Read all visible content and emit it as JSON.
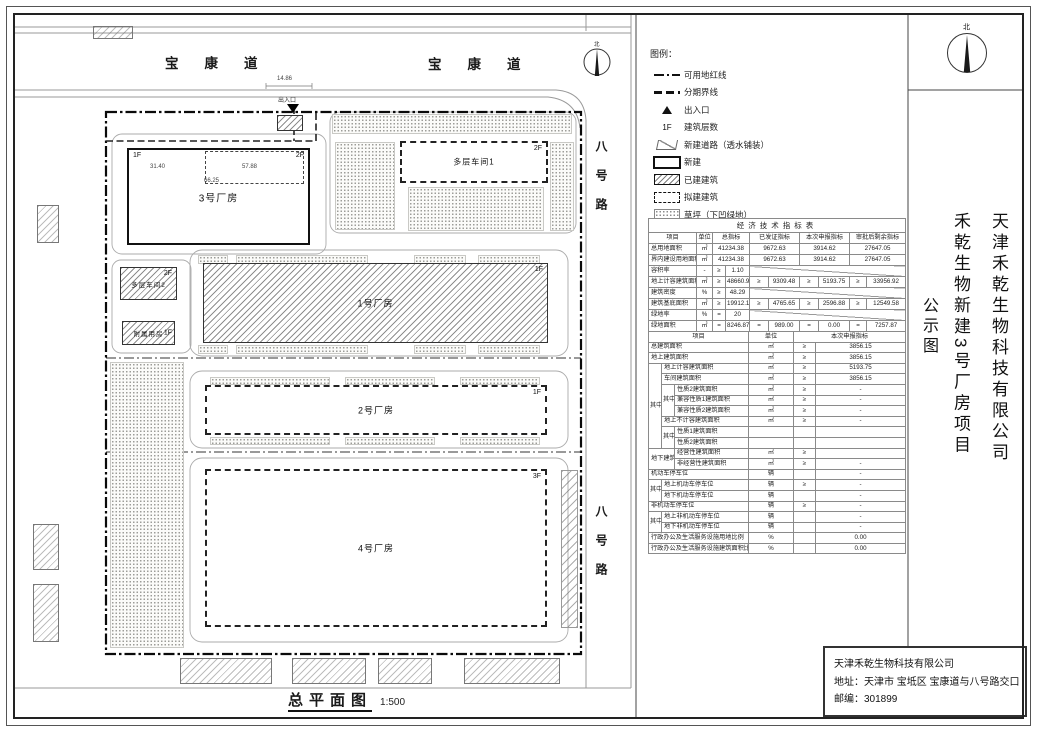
{
  "misc": {
    "north": "北"
  },
  "plan": {
    "title": "总平面图",
    "scale": "1:500",
    "roads": {
      "top1": "宝康道",
      "top2": "宝康道",
      "right1": "八号路",
      "right2": "八号路"
    },
    "entrance": {
      "label": "出入口",
      "dim": "14.86"
    },
    "dims": {
      "w1": "31.40",
      "w2": "57.88",
      "total": "66.25"
    },
    "buildings": [
      {
        "id": "plant3",
        "name": "3号厂房",
        "type": "new",
        "x": 127,
        "y": 148,
        "w": 183,
        "h": 97,
        "fs": 10,
        "fl": [
          [
            "1F",
            "tl"
          ],
          [
            "2F",
            "tr"
          ]
        ]
      },
      {
        "id": "plant3-2f-extent",
        "name": "",
        "type": "sub",
        "x": 205,
        "y": 151,
        "w": 99,
        "h": 33,
        "fl": []
      },
      {
        "id": "workshop1",
        "name": "多层车间1",
        "type": "proposed",
        "x": 400,
        "y": 141,
        "w": 148,
        "h": 42,
        "fs": 8,
        "fl": [
          [
            "2F",
            "tr"
          ]
        ]
      },
      {
        "id": "workshop2",
        "name": "多层车间2",
        "type": "existing",
        "x": 120,
        "y": 267,
        "w": 57,
        "h": 33,
        "fs": 6.5,
        "fl": [
          [
            "2F",
            "tr"
          ]
        ]
      },
      {
        "id": "annex",
        "name": "附属用房",
        "type": "existing",
        "x": 122,
        "y": 321,
        "w": 53,
        "h": 24,
        "fs": 6.5,
        "fl": [
          [
            "1F",
            "r"
          ]
        ]
      },
      {
        "id": "plant1",
        "name": "1号厂房",
        "type": "existing",
        "x": 203,
        "y": 263,
        "w": 345,
        "h": 80,
        "fs": 9,
        "fl": [
          [
            "1F",
            "tr"
          ]
        ]
      },
      {
        "id": "plant2",
        "name": "2号厂房",
        "type": "proposed",
        "x": 205,
        "y": 385,
        "w": 342,
        "h": 50,
        "fs": 9,
        "fl": [
          [
            "1F",
            "tr"
          ]
        ]
      },
      {
        "id": "plant4",
        "name": "4号厂房",
        "type": "proposed",
        "x": 205,
        "y": 469,
        "w": 342,
        "h": 158,
        "fs": 9,
        "fl": [
          [
            "3F",
            "tr"
          ]
        ]
      },
      {
        "id": "gatehouse",
        "name": "",
        "type": "existing",
        "x": 277,
        "y": 115,
        "w": 26,
        "h": 16,
        "fl": []
      }
    ],
    "lawns": [
      [
        332,
        114,
        240,
        20
      ],
      [
        335,
        142,
        60,
        88
      ],
      [
        408,
        187,
        136,
        44
      ],
      [
        550,
        142,
        24,
        89
      ],
      [
        198,
        255,
        30,
        9
      ],
      [
        236,
        255,
        132,
        9
      ],
      [
        414,
        255,
        52,
        9
      ],
      [
        478,
        255,
        62,
        9
      ],
      [
        198,
        345,
        30,
        9
      ],
      [
        236,
        345,
        132,
        9
      ],
      [
        414,
        345,
        52,
        9
      ],
      [
        478,
        345,
        62,
        9
      ],
      [
        210,
        377,
        120,
        8
      ],
      [
        345,
        377,
        90,
        8
      ],
      [
        460,
        377,
        80,
        8
      ],
      [
        210,
        437,
        120,
        8
      ],
      [
        345,
        437,
        90,
        8
      ],
      [
        460,
        437,
        80,
        8
      ],
      [
        110,
        362,
        74,
        286
      ]
    ],
    "parking": [
      [
        561,
        470,
        17,
        158
      ]
    ],
    "outside": [
      [
        180,
        658,
        92,
        26
      ],
      [
        292,
        658,
        74,
        26
      ],
      [
        378,
        658,
        54,
        26
      ],
      [
        464,
        658,
        96,
        26
      ],
      [
        37,
        205,
        22,
        38
      ],
      [
        33,
        524,
        26,
        46
      ],
      [
        33,
        584,
        26,
        58
      ],
      [
        93,
        26,
        40,
        13
      ]
    ]
  },
  "legend": {
    "title": "图例：",
    "items": [
      {
        "sym": "redline",
        "label": "可用地红线"
      },
      {
        "sym": "phaseline",
        "label": "分期界线"
      },
      {
        "sym": "entry",
        "label": "出入口"
      },
      {
        "sym": "floors",
        "symText": "1F",
        "label": "建筑层数"
      },
      {
        "sym": "newroad",
        "label": "新建道路（透水铺装）"
      },
      {
        "sym": "newbuild",
        "label": "新建"
      },
      {
        "sym": "built",
        "label": "已建建筑"
      },
      {
        "sym": "proposed",
        "label": "拟建建筑"
      },
      {
        "sym": "lawn",
        "label": "草坪（下凹绿地）"
      },
      {
        "sym": "parking",
        "label": "机动车停车位"
      }
    ]
  },
  "table": {
    "title": "经济技术指标表",
    "sec1": {
      "header": [
        {
          "t": "项目"
        },
        {
          "t": "单位"
        },
        {
          "t": "总指标",
          "cs": 2
        },
        {
          "t": "已发证指标",
          "cs": 2
        },
        {
          "t": "本次申报指标",
          "cs": 2
        },
        {
          "t": "审批后剩余指标",
          "cs": 2
        }
      ],
      "rows": [
        {
          "label": "总用地面积",
          "unit": "㎡",
          "g": [
            {
              "v": "41234.38"
            },
            {
              "v": "9672.63"
            },
            {
              "v": "3914.62"
            },
            {
              "v": "27647.05"
            }
          ]
        },
        {
          "label": "界内建设用地面积",
          "unit": "㎡",
          "g": [
            {
              "v": "41234.38"
            },
            {
              "v": "9672.63"
            },
            {
              "v": "3914.62"
            },
            {
              "v": "27647.05"
            }
          ]
        },
        {
          "label": "容积率",
          "unit": "-",
          "g": [
            {
              "s": "≥",
              "v": "1.10"
            },
            {
              "diag": 6
            }
          ]
        },
        {
          "label": "地上计容建筑面积",
          "unit": "㎡",
          "g": [
            {
              "s": "≥",
              "v": "48660.97"
            },
            {
              "s": "≥",
              "v": "9309.48"
            },
            {
              "s": "≥",
              "v": "5193.75"
            },
            {
              "s": "≥",
              "v": "33956.92"
            }
          ]
        },
        {
          "label": "建筑密度",
          "unit": "%",
          "g": [
            {
              "s": "≥",
              "v": "48.29"
            },
            {
              "diag": 6
            }
          ]
        },
        {
          "label": "建筑基底面积",
          "unit": "㎡",
          "g": [
            {
              "s": "≥",
              "v": "19912.11"
            },
            {
              "s": "≥",
              "v": "4765.65"
            },
            {
              "s": "≥",
              "v": "2596.88"
            },
            {
              "s": "≥",
              "v": "12549.58"
            }
          ]
        },
        {
          "label": "绿地率",
          "unit": "%",
          "g": [
            {
              "s": "=",
              "v": "20"
            },
            {
              "diag": 6
            }
          ]
        },
        {
          "label": "绿地面积",
          "unit": "㎡",
          "g": [
            {
              "s": "=",
              "v": "8246.87"
            },
            {
              "s": "=",
              "v": "989.00"
            },
            {
              "s": "=",
              "v": "0.00"
            },
            {
              "s": "=",
              "v": "7257.87"
            }
          ]
        }
      ]
    },
    "sec2": {
      "rows": [
        [
          {
            "t": "项目",
            "cs": 3
          },
          {
            "t": "单位"
          },
          {
            "t": "本次申报指标",
            "cs": 2
          }
        ],
        [
          {
            "t": "总建筑面积",
            "cs": 3,
            "cls": "lft"
          },
          {
            "t": "㎡"
          },
          {
            "t": "≥"
          },
          {
            "t": "3856.15"
          }
        ],
        [
          {
            "t": "地上建筑面积",
            "cs": 3,
            "cls": "lft"
          },
          {
            "t": "㎡"
          },
          {
            "t": "≥"
          },
          {
            "t": "3856.15"
          }
        ],
        [
          {
            "t": "其中",
            "rs": 8
          },
          {
            "t": "地上计容建筑面积",
            "cs": 2,
            "cls": "lft"
          },
          {
            "t": "㎡"
          },
          {
            "t": "≥"
          },
          {
            "t": "5193.75"
          }
        ],
        [
          {
            "t": "车间建筑面积",
            "cs": 2,
            "cls": "lft"
          },
          {
            "t": "㎡"
          },
          {
            "t": "≥"
          },
          {
            "t": "3856.15"
          }
        ],
        [
          {
            "t": "其中",
            "rs": 3
          },
          {
            "t": "性质2建筑面积",
            "cls": "lft"
          },
          {
            "t": "㎡"
          },
          {
            "t": "≥"
          },
          {
            "t": "-"
          }
        ],
        [
          {
            "t": "兼容性质1建筑面积",
            "cls": "lft"
          },
          {
            "t": "㎡"
          },
          {
            "t": "≥"
          },
          {
            "t": "-"
          }
        ],
        [
          {
            "t": "兼容性质2建筑面积",
            "cls": "lft"
          },
          {
            "t": "㎡"
          },
          {
            "t": "≥"
          },
          {
            "t": "-"
          }
        ],
        [
          {
            "t": "地上不计容建筑面积",
            "cs": 2,
            "cls": "lft"
          },
          {
            "t": "㎡"
          },
          {
            "t": "≥"
          },
          {
            "t": "-"
          }
        ],
        [
          {
            "t": "其中",
            "rs": 2
          },
          {
            "t": "性质1建筑面积",
            "cls": "lft"
          },
          {
            "t": ""
          },
          {
            "t": ""
          },
          {
            "t": ""
          }
        ],
        [
          {
            "t": "性质2建筑面积",
            "cls": "lft"
          },
          {
            "t": ""
          },
          {
            "t": ""
          },
          {
            "t": ""
          }
        ],
        [
          {
            "t": "地下建筑面积",
            "cs": 2,
            "rs": 2,
            "cls": "lft"
          },
          {
            "t": "经营性建筑面积",
            "cls": "lft"
          },
          {
            "t": "㎡"
          },
          {
            "t": "≥"
          },
          {
            "t": ""
          }
        ],
        [
          {
            "t": "非经营性建筑面积",
            "cls": "lft"
          },
          {
            "t": "㎡"
          },
          {
            "t": "≥"
          },
          {
            "t": "-"
          }
        ],
        [
          {
            "t": "机动车停车位",
            "cs": 3,
            "cls": "lft"
          },
          {
            "t": "辆"
          },
          {
            "t": ""
          },
          {
            "t": "-"
          }
        ],
        [
          {
            "t": "其中",
            "rs": 2
          },
          {
            "t": "地上机动车停车位",
            "cs": 2,
            "cls": "lft"
          },
          {
            "t": "辆"
          },
          {
            "t": "≥"
          },
          {
            "t": "-"
          }
        ],
        [
          {
            "t": "地下机动车停车位",
            "cs": 2,
            "cls": "lft"
          },
          {
            "t": "辆"
          },
          {
            "t": ""
          },
          {
            "t": "-"
          }
        ],
        [
          {
            "t": "非机动车停车位",
            "cs": 3,
            "cls": "lft"
          },
          {
            "t": "辆"
          },
          {
            "t": "≥"
          },
          {
            "t": "-"
          }
        ],
        [
          {
            "t": "其中",
            "rs": 2
          },
          {
            "t": "地上非机动车停车位",
            "cs": 2,
            "cls": "lft"
          },
          {
            "t": "辆"
          },
          {
            "t": ""
          },
          {
            "t": "-"
          }
        ],
        [
          {
            "t": "地下非机动车停车位",
            "cs": 2,
            "cls": "lft"
          },
          {
            "t": "辆"
          },
          {
            "t": ""
          },
          {
            "t": "-"
          }
        ],
        [
          {
            "t": "行政办公及生活服务设施用地比例",
            "cs": 3,
            "cls": "lft"
          },
          {
            "t": "%"
          },
          {
            "t": ""
          },
          {
            "t": "0.00"
          }
        ],
        [
          {
            "t": "行政办公及生活服务设施建筑面积比例",
            "cs": 3,
            "cls": "lft"
          },
          {
            "t": "%"
          },
          {
            "t": ""
          },
          {
            "t": "0.00"
          }
        ]
      ]
    }
  },
  "titleblock": {
    "company": "天津禾乾生物科技有限公司",
    "project": "禾乾生物新建3号厂房项目",
    "doc": "公示图"
  },
  "company": {
    "name": "天津禾乾生物科技有限公司",
    "address": "地址：天津市 宝坻区 宝康道与八号路交口",
    "zip": "邮编：301899"
  }
}
